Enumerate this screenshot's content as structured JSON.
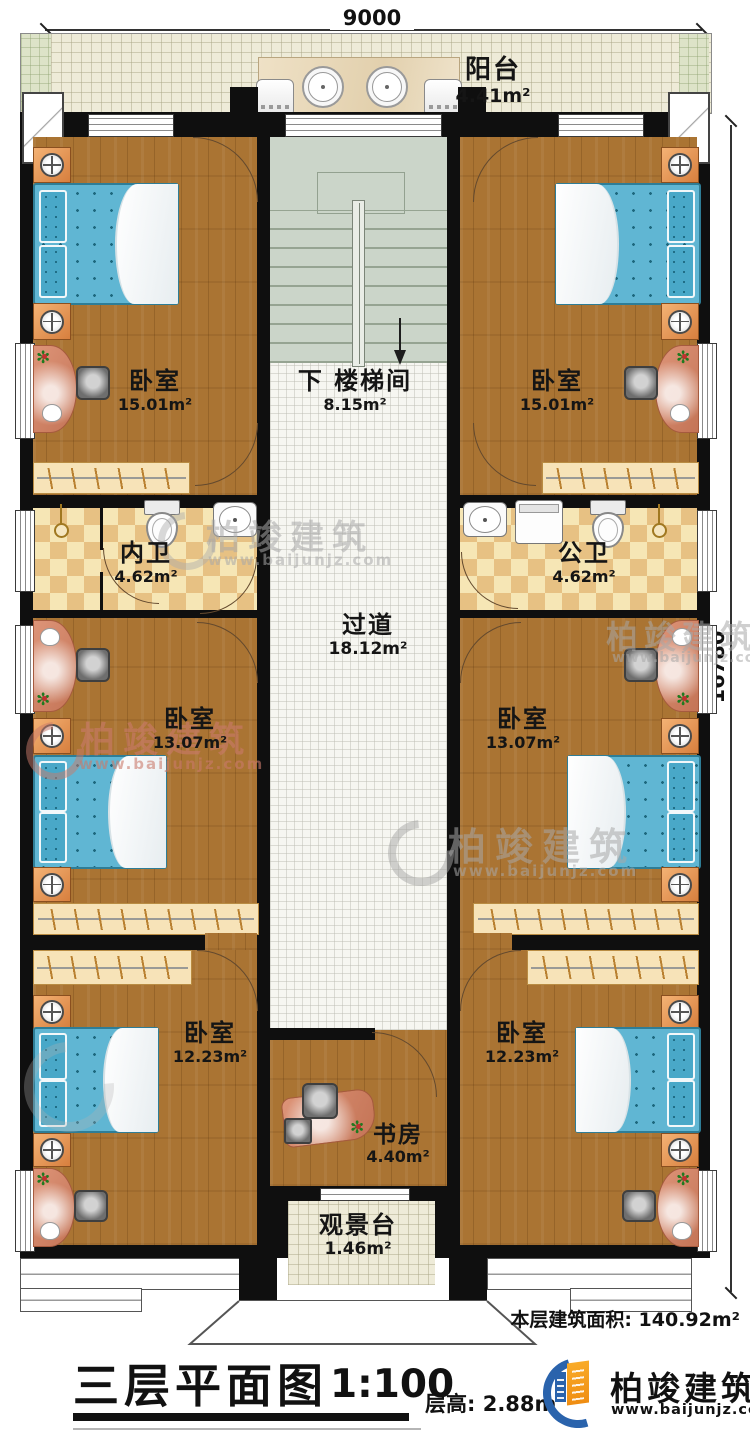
{
  "dimensions": {
    "width_label": "9000",
    "height_label": "16780"
  },
  "rooms": [
    {
      "id": "balcony",
      "name": "阳台",
      "area": "4.41m²"
    },
    {
      "id": "bedroom-top-left",
      "name": "卧室",
      "area": "15.01m²"
    },
    {
      "id": "stairwell",
      "prefix": "下",
      "name": "楼梯间",
      "area": "8.15m²"
    },
    {
      "id": "bedroom-top-right",
      "name": "卧室",
      "area": "15.01m²"
    },
    {
      "id": "bath-inner",
      "name": "内卫",
      "area": "4.62m²"
    },
    {
      "id": "bath-public",
      "name": "公卫",
      "area": "4.62m²"
    },
    {
      "id": "corridor",
      "name": "过道",
      "area": "18.12m²"
    },
    {
      "id": "bedroom-mid-left",
      "name": "卧室",
      "area": "13.07m²"
    },
    {
      "id": "bedroom-mid-right",
      "name": "卧室",
      "area": "13.07m²"
    },
    {
      "id": "bedroom-bottom-left",
      "name": "卧室",
      "area": "12.23m²"
    },
    {
      "id": "bedroom-bottom-right",
      "name": "卧室",
      "area": "12.23m²"
    },
    {
      "id": "study",
      "name": "书房",
      "area": "4.40m²"
    },
    {
      "id": "viewing-deck",
      "name": "观景台",
      "area": "1.46m²"
    }
  ],
  "footer": {
    "floor_area_label": "本层建筑面积:",
    "floor_area_value": "140.92m²",
    "title": "三层平面图",
    "scale": "1:100",
    "floor_height_label": "层高:",
    "floor_height_value": "2.88m"
  },
  "brand": {
    "name": "柏竣建筑",
    "website": "www.baijunjz.com"
  },
  "watermark": {
    "name": "柏竣建筑",
    "website": "www.baijunjz.com"
  },
  "colors": {
    "wall": "#0f0f0f",
    "wood": "#aa7433",
    "bed": "#60b6d3",
    "logo_blue": "#2a63ac",
    "logo_orange": "#f6a01f"
  }
}
